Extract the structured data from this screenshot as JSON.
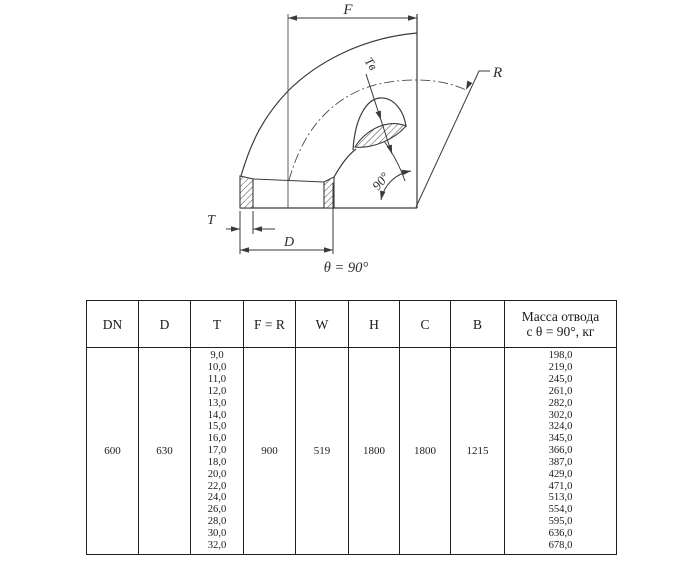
{
  "ink_color": "#3a3a3a",
  "drawing": {
    "labels": {
      "f": "F",
      "r": "R",
      "t": "T",
      "d": "D",
      "tv": "Tв",
      "angle": "90°",
      "theta_caption": "θ = 90°"
    }
  },
  "table": {
    "headers": [
      "DN",
      "D",
      "T",
      "F = R",
      "W",
      "H",
      "C",
      "B",
      "Масса отвода\nс θ =  90°, кг"
    ],
    "dn": "600",
    "d": "630",
    "f_r": "900",
    "w": "519",
    "h": "1800",
    "c": "1800",
    "b": "1215",
    "t_values": [
      "9,0",
      "10,0",
      "11,0",
      "12,0",
      "13,0",
      "14,0",
      "15,0",
      "16,0",
      "17,0",
      "18,0",
      "20,0",
      "22,0",
      "24,0",
      "26,0",
      "28,0",
      "30,0",
      "32,0"
    ],
    "mass_values": [
      "198,0",
      "219,0",
      "245,0",
      "261,0",
      "282,0",
      "302,0",
      "324,0",
      "345,0",
      "366,0",
      "387,0",
      "429,0",
      "471,0",
      "513,0",
      "554,0",
      "595,0",
      "636,0",
      "678,0"
    ]
  }
}
